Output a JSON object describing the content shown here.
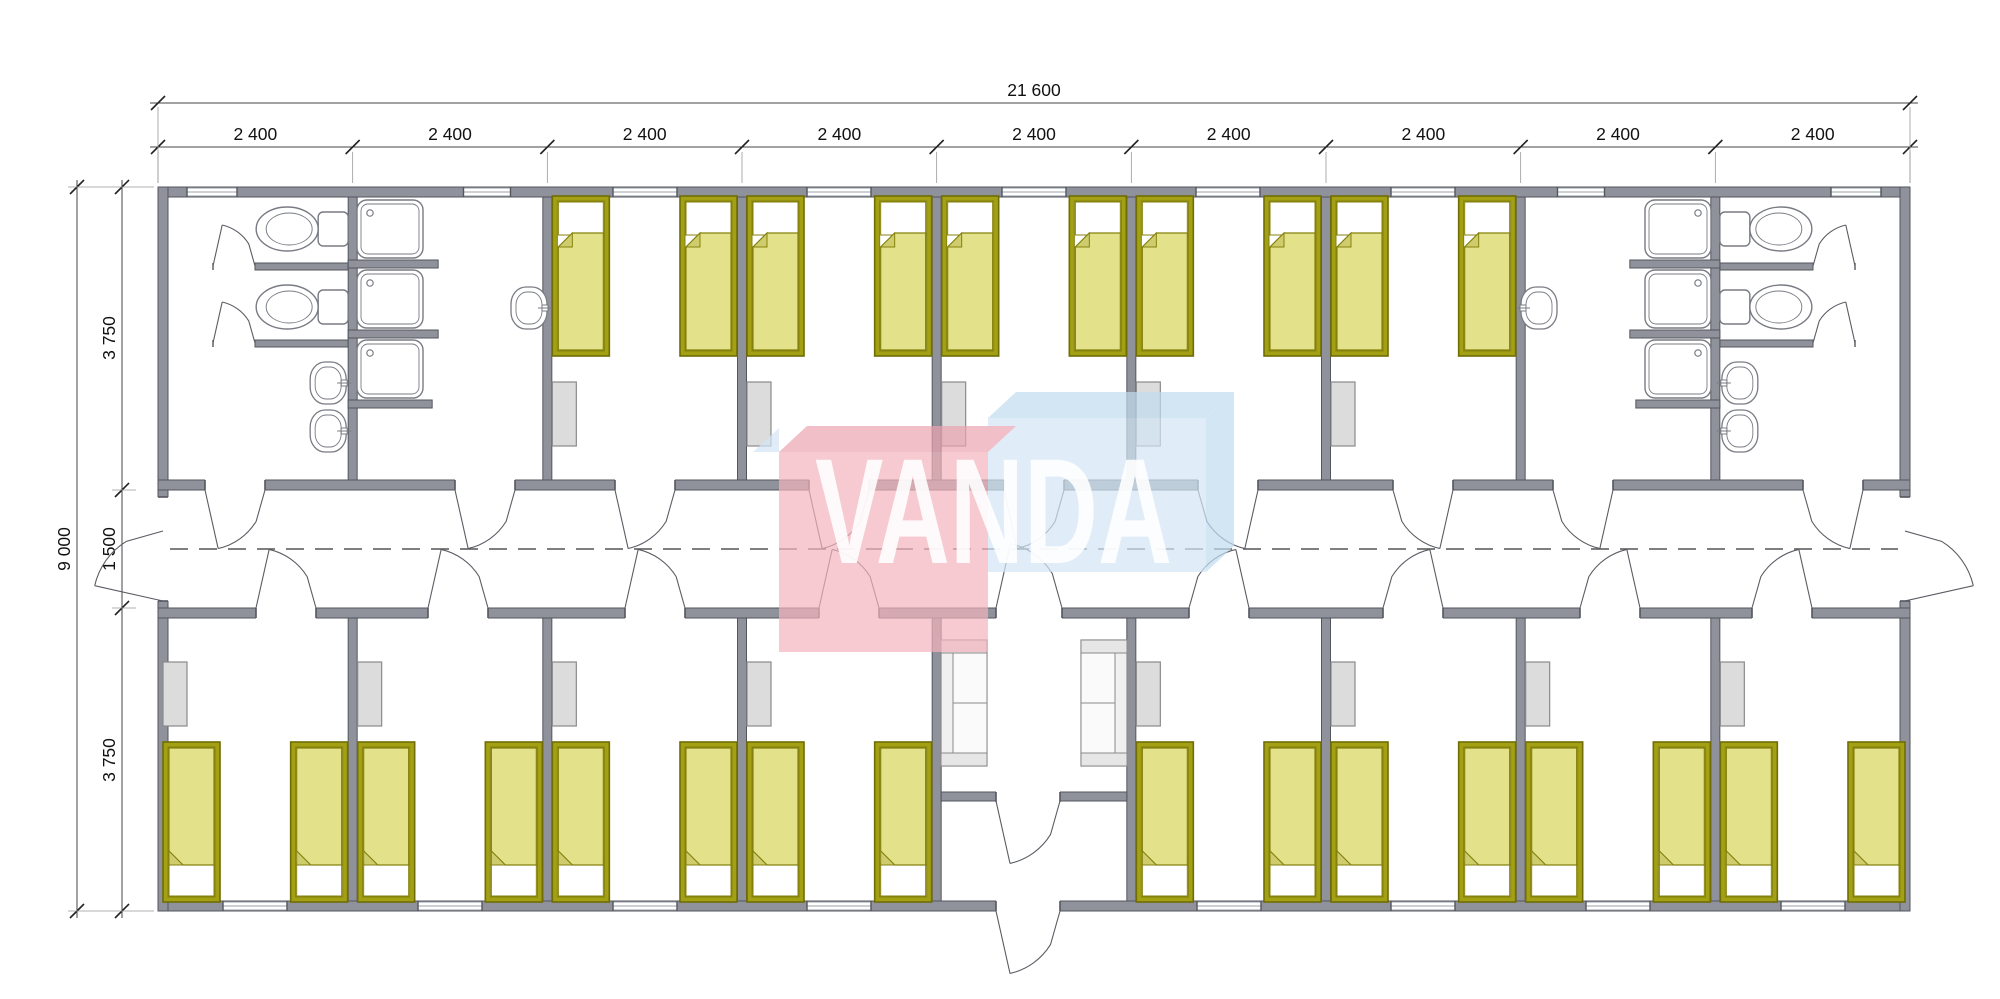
{
  "page": {
    "background": "#ffffff",
    "description": "Modular building floor plan, 9 modules, central corridor, bedrooms with single beds, shared bathrooms at both ends, central entrance lobby"
  },
  "watermark": {
    "text": "VANDA",
    "text_color": "#ffffff",
    "red_face": "#f3b4bd",
    "red_top": "#eba4b1",
    "blue_face": "#d3e6f6",
    "blue_top": "#c1dcf0",
    "blocks_opacity": 0.7,
    "text_opacity": 0.88
  },
  "dimensions": {
    "overall_width": {
      "label": "21 600",
      "value_mm": 21600
    },
    "modules": {
      "label": "2 400",
      "value_mm": 2400,
      "count": 9
    },
    "overall_depth": {
      "label": "9 000",
      "value_mm": 9000
    },
    "depth_sections": [
      {
        "label": "3 750",
        "value_mm": 3750
      },
      {
        "label": "1 500",
        "value_mm": 1500
      },
      {
        "label": "3 750",
        "value_mm": 3750
      }
    ]
  },
  "inventory": {
    "bedrooms": 13,
    "beds": 26,
    "wardrobes": 13,
    "shower_trays": 6,
    "toilets": 4,
    "wash_basins": 6,
    "sofas": 2,
    "shared_bathrooms": 2,
    "entrance_lobbies": 1,
    "corridors": 1
  },
  "colors": {
    "wall_fill": "#8f929b",
    "wall_stroke": "#53565e",
    "thin_line": "#6f727a",
    "fixture_stroke": "#787b83",
    "bed_frame": "#a3a013",
    "bed_frame_stroke": "#6f6d05",
    "bed_blanket": "#e3e18a",
    "bed_blanket_stroke": "#84820c",
    "bed_fold": "#cfcc6e",
    "bed_white": "#ffffff",
    "furniture_fill": "#dcdcdc",
    "furniture_stroke": "#8a8a8a",
    "sofa_fill": "#f0f0f0",
    "dim_line": "#444444",
    "witness_line": "#999999",
    "centerline": "#555555",
    "window_line": "#9aa0a8"
  },
  "plan": {
    "px": {
      "x0": 158,
      "x1": 1910,
      "module_count": 9,
      "y_top": 187,
      "y_cor_top": 480,
      "y_cor_bot": 608,
      "y_bot": 901,
      "ext_wall": 10,
      "partition": 9,
      "corridor_center_y": 549,
      "mirror": 2068
    },
    "top_windows": [
      {
        "c": 212,
        "w": 50
      },
      {
        "c": 487,
        "w": 47
      },
      {
        "c": 645,
        "w": 64
      },
      {
        "c": 839,
        "w": 64
      },
      {
        "c": 1034,
        "w": 64
      },
      {
        "c": 1228,
        "w": 64
      },
      {
        "c": 1423,
        "w": 64
      },
      {
        "c": 1581,
        "w": 47
      },
      {
        "c": 1856,
        "w": 50
      }
    ],
    "bottom_windows": [
      255,
      450,
      645,
      839,
      1229,
      1423,
      1618,
      1813
    ],
    "corridor_top_door_centers": [
      235,
      485,
      645,
      839,
      1034,
      1228,
      1423,
      1583,
      1833
    ],
    "corridor_bottom_door_centers": [
      286,
      458,
      655,
      849,
      1219,
      1413,
      1610,
      1782
    ],
    "lobby_door_center": 1029,
    "entrance_opening": {
      "x1": 996,
      "x2": 1060
    },
    "end_door_opening_y": {
      "y1": 497,
      "y2": 601
    },
    "top_bedroom_modules": [
      2,
      3,
      4,
      5,
      6
    ],
    "bottom_bedroom_modules": [
      0,
      1,
      2,
      3,
      5,
      6,
      7,
      8
    ],
    "lobby_module": 4,
    "bed": {
      "w": 57,
      "h": 160
    },
    "wardrobe": {
      "w": 24,
      "h": 64,
      "y_top_row": 382,
      "y_bottom_row": 662
    },
    "showers_left_x": 357,
    "shower_w": 66,
    "shower_h": 58,
    "shower_rows_y": [
      200,
      270,
      340
    ],
    "toilet_centers_y": [
      229,
      307
    ],
    "toilet_room_basins_y": [
      362,
      410
    ],
    "shower_room_basin": {
      "x": 511,
      "y": 287
    },
    "sofa": {
      "w": 46,
      "h": 126,
      "left_x": 941,
      "right_x": 1081,
      "y": 640
    },
    "vestibule_wall_y": 792
  }
}
